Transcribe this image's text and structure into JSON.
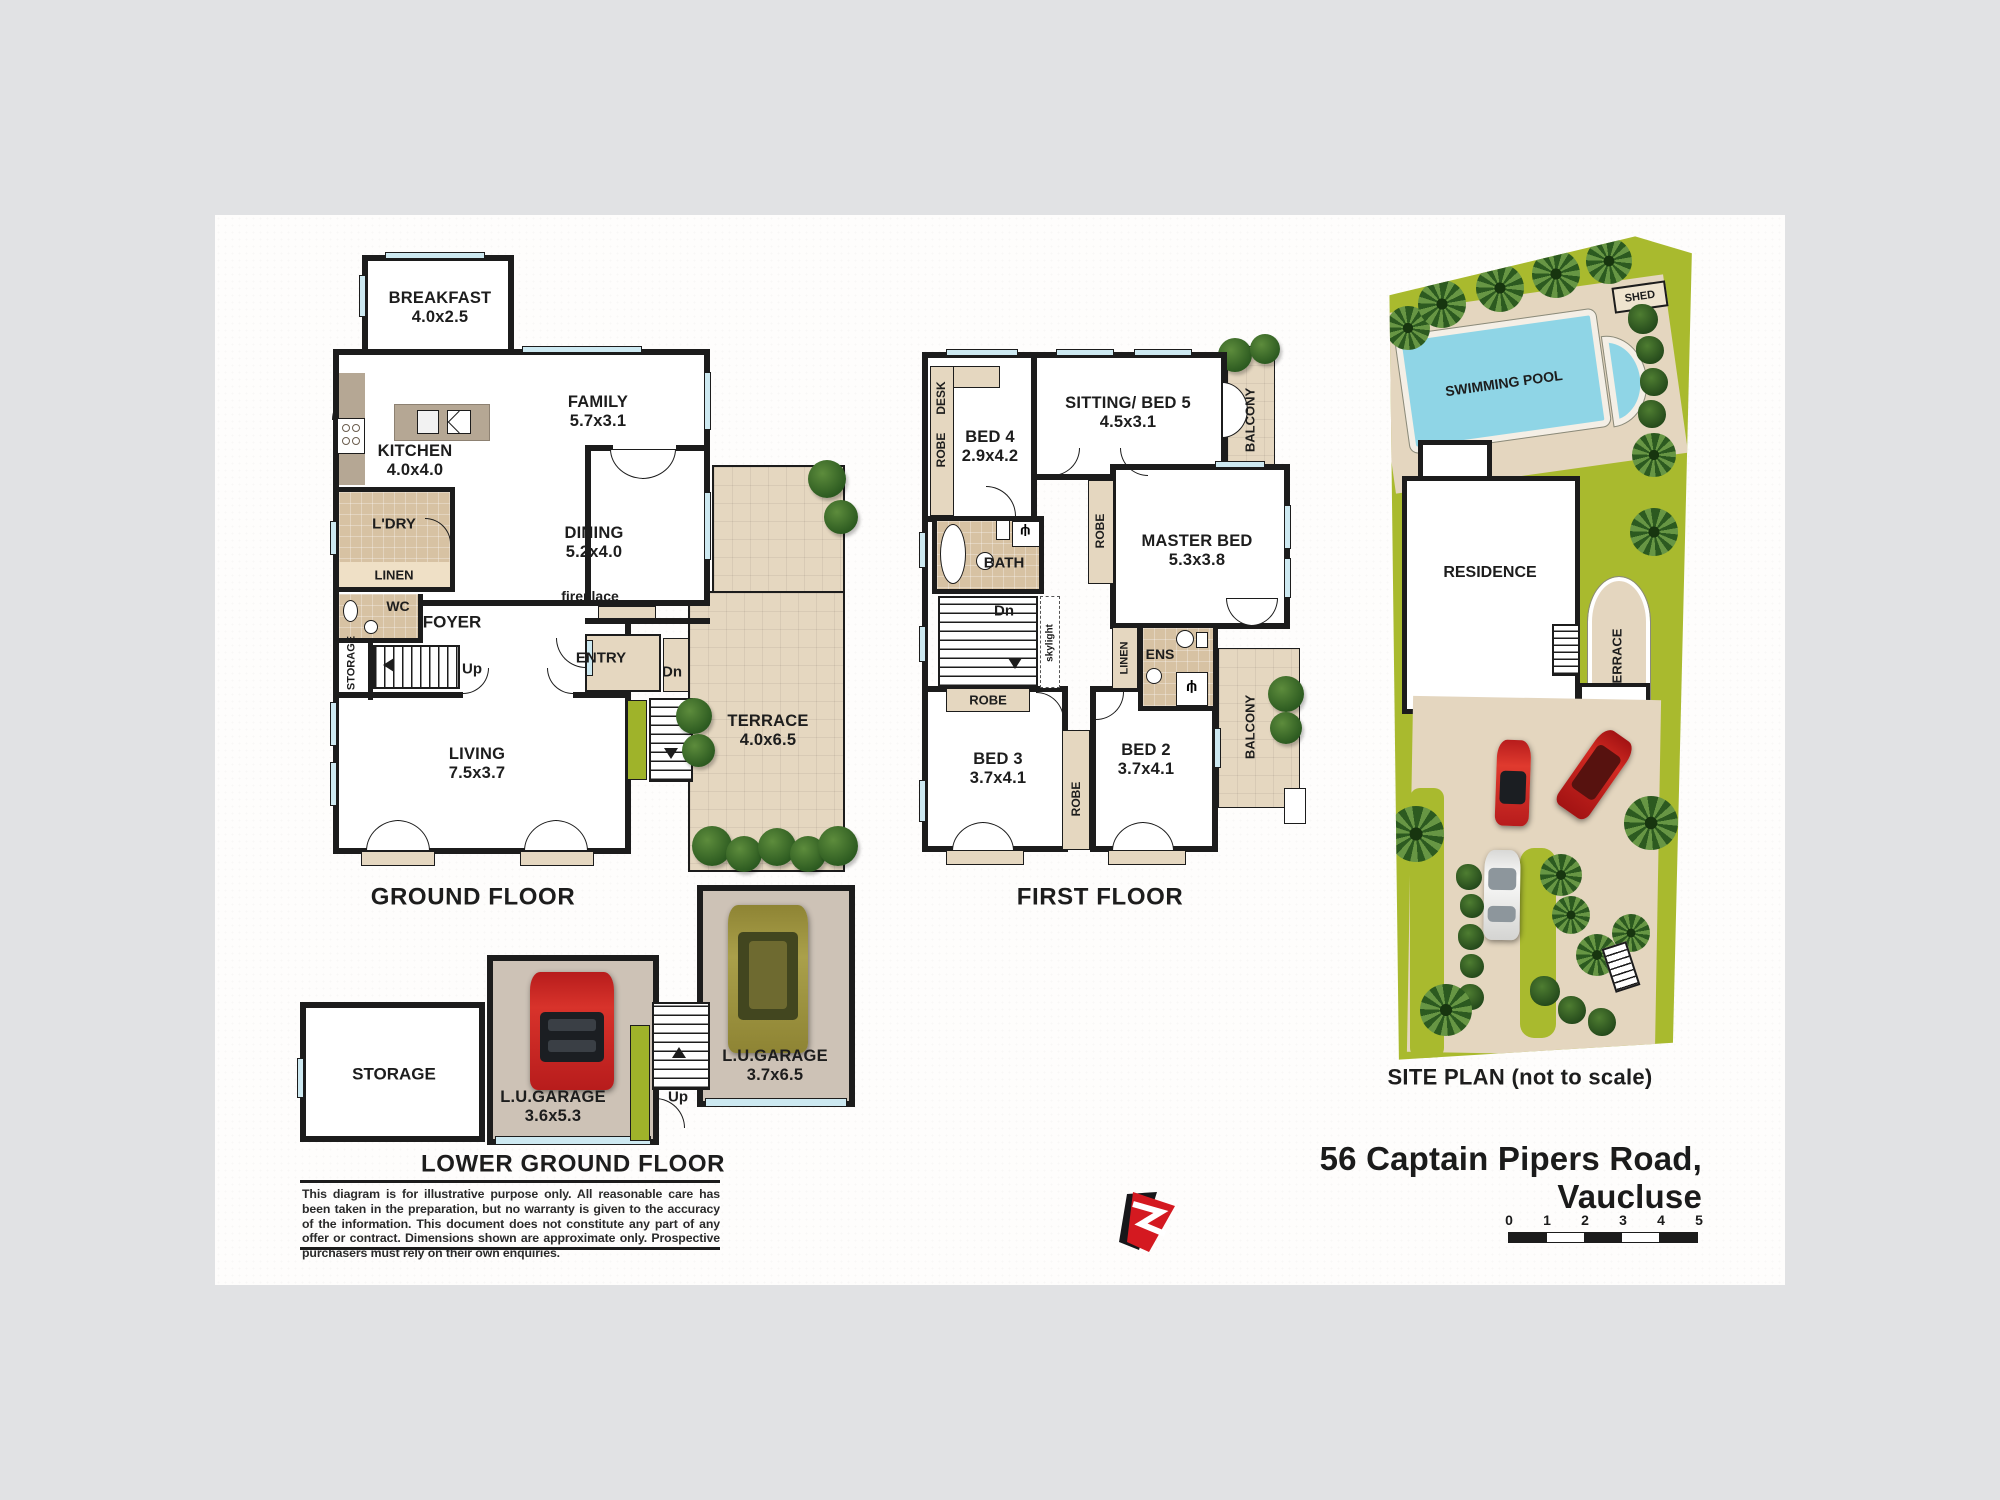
{
  "address": "56 Captain Pipers Road, Vaucluse",
  "ground": {
    "title": "GROUND FLOOR",
    "breakfast": {
      "name": "BREAKFAST",
      "dims": "4.0x2.5"
    },
    "family": {
      "name": "FAMILY",
      "dims": "5.7x3.1"
    },
    "kitchen": {
      "name": "KITCHEN",
      "dims": "4.0x4.0"
    },
    "dining": {
      "name": "DINING",
      "dims": "5.2x4.0"
    },
    "living": {
      "name": "LIVING",
      "dims": "7.5x3.7"
    },
    "terrace": {
      "name": "TERRACE",
      "dims": "4.0x6.5"
    },
    "ldry": "L'DRY",
    "linen": "LINEN",
    "wc": "WC",
    "foyer": "FOYER",
    "storage": "STORAGE",
    "entry": "ENTRY",
    "fireplace": "fireplace",
    "up": "Up",
    "dn": "Dn"
  },
  "first": {
    "title": "FIRST FLOOR",
    "bed4": {
      "name": "BED 4",
      "dims": "2.9x4.2"
    },
    "sitting": {
      "name": "SITTING/ BED 5",
      "dims": "4.5x3.1"
    },
    "master": {
      "name": "MASTER BED",
      "dims": "5.3x3.8"
    },
    "bed3": {
      "name": "BED 3",
      "dims": "3.7x4.1"
    },
    "bed2": {
      "name": "BED 2",
      "dims": "3.7x4.1"
    },
    "bath": "BATH",
    "ens": "ENS",
    "linen": "LINEN",
    "robe": "ROBE",
    "desk": "DESK",
    "balcony": "BALCONY",
    "skylight": "skylight",
    "dn": "Dn"
  },
  "lower": {
    "title": "LOWER GROUND FLOOR",
    "storage": "STORAGE",
    "garage1": {
      "name": "L.U.GARAGE",
      "dims": "3.6x5.3"
    },
    "garage2": {
      "name": "L.U.GARAGE",
      "dims": "3.7x6.5"
    },
    "up": "Up"
  },
  "site": {
    "title": "SITE PLAN (not to scale)",
    "pool": "SWIMMING POOL",
    "shed": "SHED",
    "residence": "RESIDENCE",
    "terrace": "TERRACE"
  },
  "disclaimer": "This diagram is for illustrative purpose only. All reasonable care has been taken in the preparation, but no warranty is given to the accuracy of the information. This document does not constitute any part of any offer or contract. Dimensions shown are approximate only. Prospective purchasers must rely on their own enquiries.",
  "scale": {
    "ticks": [
      "0",
      "1",
      "2",
      "3",
      "4",
      "5"
    ]
  },
  "colors": {
    "wall": "#1c1c1c",
    "deck_tan": "#e5d7c0",
    "tile_tan": "#d7c2a3",
    "window_blue": "#cde9f1",
    "accent_green": "#9fb32a",
    "site_grass": "#a9ba2e",
    "pool_blue": "#8fd5e6",
    "logo_red": "#d41920"
  }
}
